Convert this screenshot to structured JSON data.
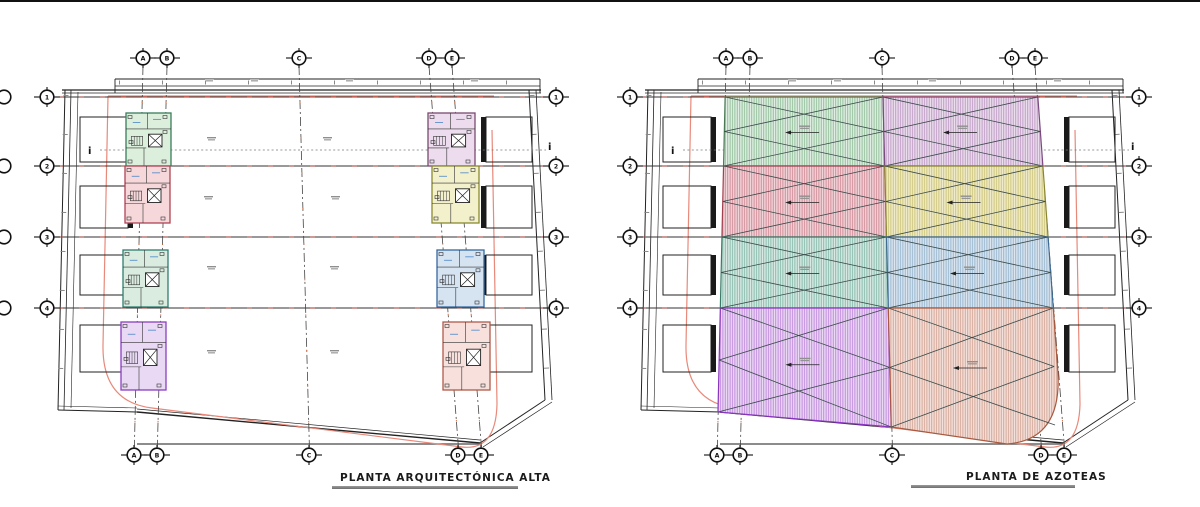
{
  "page": {
    "background": "#ffffff",
    "top_border_color": "#111111"
  },
  "titles": {
    "left": "PLANTA ARQUITECTÓNICA ALTA",
    "right": "PLANTA DE AZOTEAS"
  },
  "grid": {
    "column_axes": [
      {
        "label": "A",
        "x_top": 143,
        "x_bottom": 134
      },
      {
        "label": "B",
        "x_top": 167,
        "x_bottom": 157
      },
      {
        "label": "C",
        "x_top": 299,
        "x_bottom": 309
      },
      {
        "label": "D",
        "x_top": 429,
        "x_bottom": 458
      },
      {
        "label": "E",
        "x_top": 452,
        "x_bottom": 481
      }
    ],
    "row_axes": [
      {
        "label": "1",
        "y": 97
      },
      {
        "label": "2",
        "y": 166
      },
      {
        "label": "3",
        "y": 237
      },
      {
        "label": "4",
        "y": 308
      }
    ]
  },
  "section_marker_label": "i",
  "plans": [
    {
      "name": "upper-floor-plan",
      "title_key": "left",
      "dx": 0,
      "mode": "floor"
    },
    {
      "name": "roof-plan",
      "title_key": "right",
      "dx": 583,
      "mode": "roof"
    }
  ],
  "floor_units": [
    {
      "id": "green",
      "col": 0,
      "row": 0,
      "fill": "#dcefdc",
      "stroke": "#3a7d5c"
    },
    {
      "id": "rose",
      "col": 0,
      "row": 1,
      "fill": "#f6d7da",
      "stroke": "#b04455"
    },
    {
      "id": "teal",
      "col": 0,
      "row": 2,
      "fill": "#d9ecdf",
      "stroke": "#2e7d6e"
    },
    {
      "id": "violet",
      "col": 0,
      "row": 3,
      "fill": "#ead9f5",
      "stroke": "#8a3fc0"
    },
    {
      "id": "mauve",
      "col": 1,
      "row": 0,
      "fill": "#ecdcee",
      "stroke": "#7a4a70"
    },
    {
      "id": "yellow",
      "col": 1,
      "row": 1,
      "fill": "#f3f0cc",
      "stroke": "#8a8a30"
    },
    {
      "id": "blue",
      "col": 1,
      "row": 2,
      "fill": "#d6e4f2",
      "stroke": "#3568a0"
    },
    {
      "id": "salmon",
      "col": 1,
      "row": 3,
      "fill": "#f8e0dc",
      "stroke": "#b05a48"
    }
  ],
  "roof_regions": [
    {
      "id": "green",
      "col": 0,
      "row": 0,
      "bg": "#e2efe4",
      "hatch": "#89ba93",
      "stroke": "#4a7a55"
    },
    {
      "id": "mauve",
      "col": 1,
      "row": 0,
      "bg": "#ecdfee",
      "hatch": "#bb95c0",
      "stroke": "#7a4a80"
    },
    {
      "id": "rose",
      "col": 0,
      "row": 1,
      "bg": "#f2d6da",
      "hatch": "#cc8390",
      "stroke": "#a04050"
    },
    {
      "id": "yellow",
      "col": 1,
      "row": 1,
      "bg": "#f1edcc",
      "hatch": "#c9c070",
      "stroke": "#8a8530"
    },
    {
      "id": "teal",
      "col": 0,
      "row": 2,
      "bg": "#d9ebe4",
      "hatch": "#7eb5a4",
      "stroke": "#3a7a68"
    },
    {
      "id": "blue",
      "col": 1,
      "row": 2,
      "bg": "#dce6f0",
      "hatch": "#8fb0ca",
      "stroke": "#3f6a92"
    },
    {
      "id": "violet",
      "col": 0,
      "row": 3,
      "bg": "#ecdaf6",
      "hatch": "#bb82d8",
      "stroke": "#8a35c0"
    },
    {
      "id": "salmon",
      "col": 1,
      "row": 3,
      "bg": "#f5e2dc",
      "hatch": "#cfa08f",
      "stroke": "#a85a40"
    }
  ],
  "line_colors": {
    "property_line": "#e8897a",
    "grid": "#333333",
    "grid_dash_red": "#c0392b",
    "axis": "#444444",
    "site": "#222222",
    "section": "#777777",
    "tick_orange": "#d06030",
    "micro_text": "#8f8f8f"
  }
}
